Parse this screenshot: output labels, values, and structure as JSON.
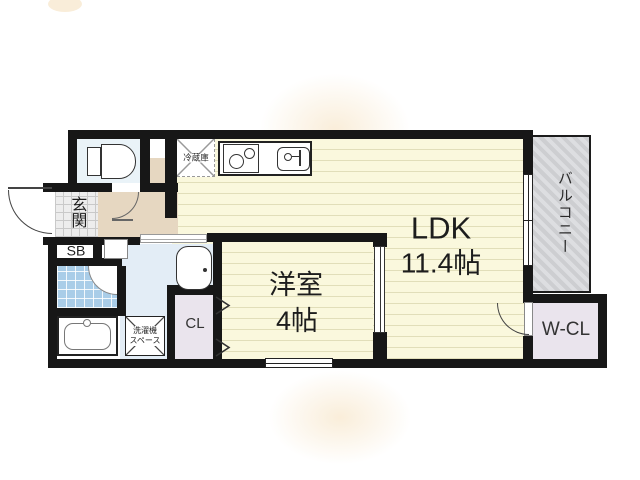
{
  "floorplan": {
    "ldk": {
      "name": "LDK",
      "size": "11.4帖"
    },
    "bedroom": {
      "name": "洋室",
      "size": "4帖"
    },
    "balcony": {
      "label": "バルコニー"
    },
    "entrance": {
      "label": "玄関"
    },
    "shoe_box": {
      "label": "SB"
    },
    "closet": {
      "label": "CL"
    },
    "walk_in_closet": {
      "label": "W-CL"
    },
    "refrigerator": {
      "label": "冷蔵庫"
    },
    "laundry": {
      "line1": "洗濯機",
      "line2": "スペース"
    },
    "colors": {
      "wall": "#171717",
      "room_floor": "#FAF8DD",
      "balcony": "#D4D4D7",
      "wet_area": "#E3EDF6",
      "shower_tile": "#A9CDE8",
      "closet": "#EAE4ED",
      "hallway": "#E6D7C1",
      "entrance_tile": "#EDEDED"
    }
  }
}
